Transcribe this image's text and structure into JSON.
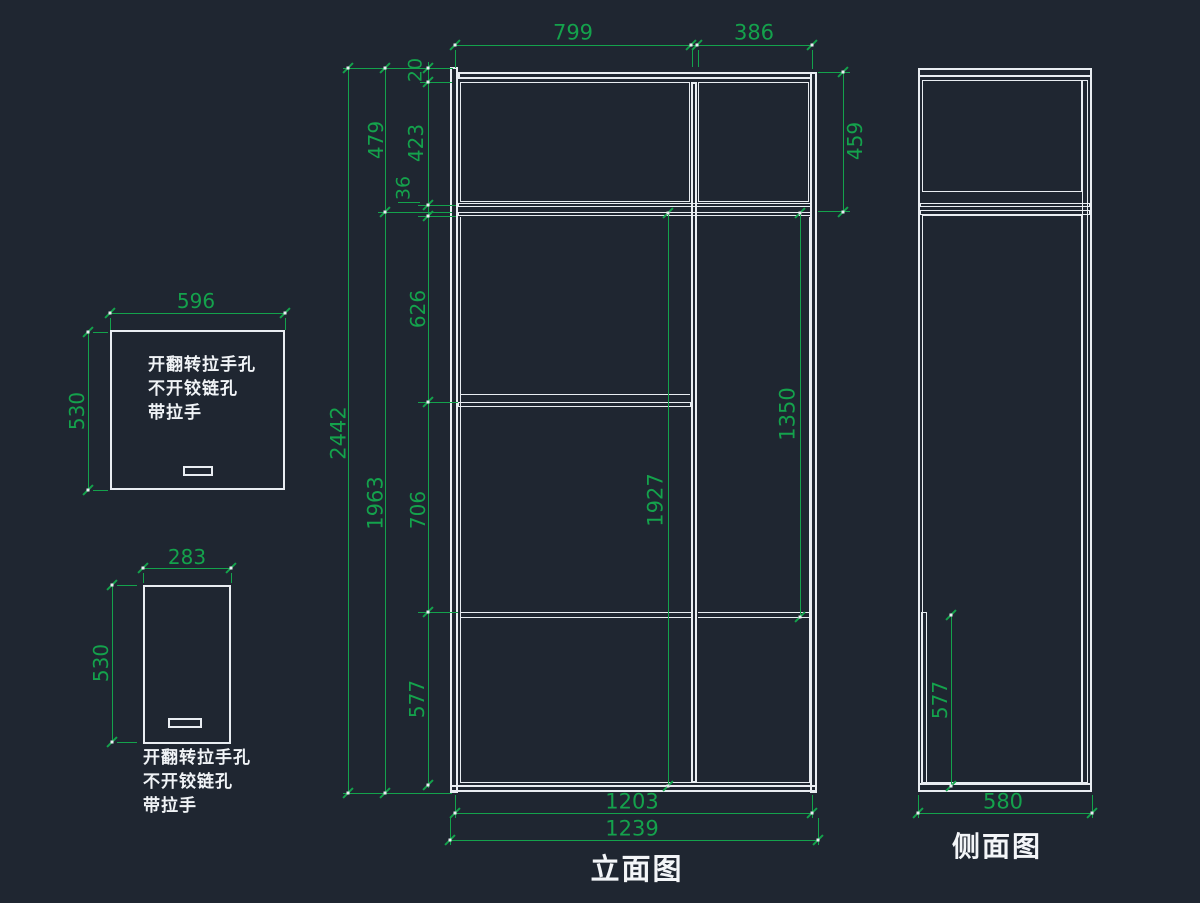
{
  "colors": {
    "background": "#1f2631",
    "line_white": "#e9edf2",
    "dimension_green": "#14a24c"
  },
  "drawing": {
    "elevation": {
      "title": "立面图",
      "dims": {
        "top_w1": "799",
        "top_w2": "386",
        "thk": "20",
        "h1": "423",
        "gap": "36",
        "h2": "626",
        "h3": "706",
        "h4": "577",
        "left_total": "2442",
        "left_upper": "479",
        "left_lower": "1963",
        "right_upper": "459",
        "inner_left": "1927",
        "inner_right": "1350",
        "bottom_inner": "1203",
        "bottom_outer": "1239"
      }
    },
    "side": {
      "title": "侧面图",
      "dims": {
        "front_panel": "577",
        "width": "580"
      }
    },
    "door_large": {
      "dims": {
        "width": "596",
        "height": "530"
      },
      "notes": [
        "开翻转拉手孔",
        "不开铰链孔",
        "带拉手"
      ]
    },
    "door_small": {
      "dims": {
        "width": "283",
        "height": "530"
      },
      "notes": [
        "开翻转拉手孔",
        "不开铰链孔",
        "带拉手"
      ]
    }
  }
}
